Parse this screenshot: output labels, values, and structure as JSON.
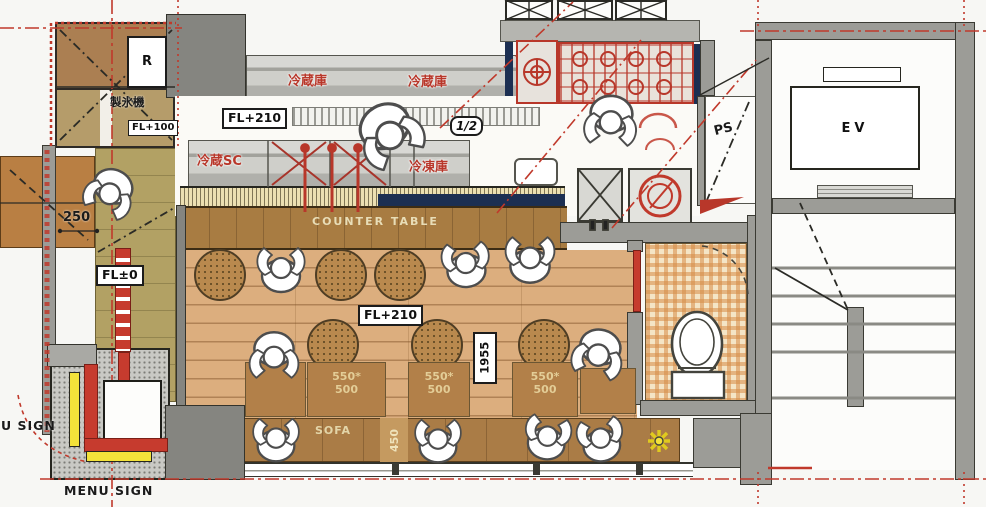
{
  "plan": {
    "storage": {
      "r": "R",
      "ice_maker": "製氷機",
      "fl": "FL+100"
    },
    "kitchen": {
      "fl": "FL+210",
      "fridge_l": "冷蔵庫",
      "fridge_r": "冷蔵庫",
      "half": "1/2",
      "showcase": "冷蔵SC",
      "freezer": "冷凍庫"
    },
    "dining": {
      "counter": "COUNTER TABLE",
      "fl": "FL+210",
      "dim_depth": "1955",
      "sofa": "SOFA",
      "dim_sofa": "450",
      "tables": [
        {
          "w": "550*",
          "d": "500"
        },
        {
          "w": "550*",
          "d": "500"
        },
        {
          "w": "550*",
          "d": "500"
        }
      ]
    },
    "entry": {
      "fl": "FL±0",
      "dim": "250"
    },
    "signs": {
      "left": "U SIGN",
      "bottom": "MENU SIGN"
    },
    "core": {
      "ps": "PS",
      "ev": "EV"
    },
    "colors": {
      "red": "#bf3a2c",
      "yellow": "#f3e23a",
      "wood": "#dcae7e",
      "counter": "#a87c42",
      "wall": "#9c9c97",
      "tile": "#f0ddba",
      "navy": "#1c2f52",
      "olive": "#b2a164"
    }
  }
}
